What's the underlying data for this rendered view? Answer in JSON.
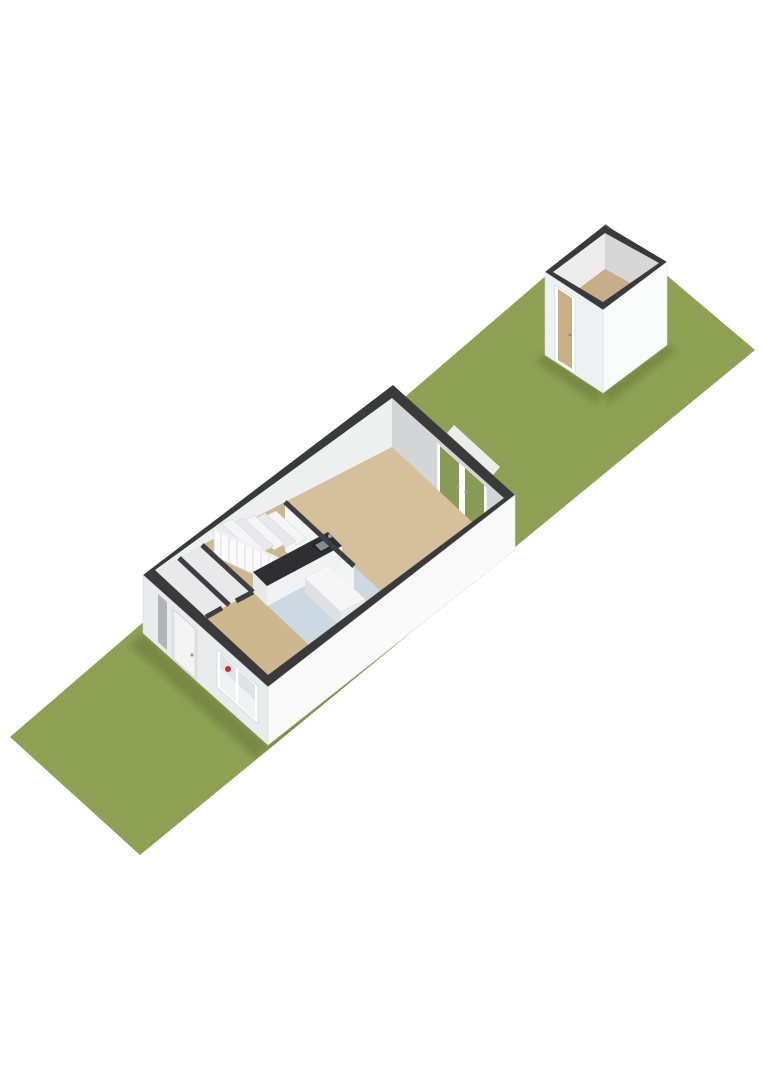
{
  "scene": {
    "type": "isometric-3d-floorplan",
    "background": "#ffffff",
    "views": {
      "plot": "long-garden-strip",
      "building": "ground-floor-open-top",
      "outbuilding": "garden-shed"
    }
  },
  "colors": {
    "grass": "#90a355",
    "grassSpeckle": "#55661f",
    "shadow": "#2f3a18",
    "rim": "#3a3a3b",
    "wallIntNW": "#eef0f0",
    "wallIntNE": "#d3d5d6",
    "wallExtSW": "#e9ebec",
    "wallExtSE": "#fafafa",
    "partitionFace": "#f4f5f5",
    "floorLiving": "#d6c09c",
    "floorHall": "#cdb78f",
    "floorKitchen": "#ccd8e2",
    "floorWc": "#e9e9e9",
    "floorEntry": "#cdb78f",
    "floorShed": "#c7ad89",
    "stairTreadA": "#f5f5f5",
    "stairTreadB": "#e9e9eb",
    "railing": "#fafafa",
    "counterTop": "#2f2f31",
    "counterFront": "#f2f2f3",
    "counterEnd": "#e8e8ea",
    "islandTop": "#f6f6f7",
    "islandSE": "#e9eaeb",
    "islandSW": "#dfe0e2",
    "sinkOuter": "#222426",
    "sinkInner": "#868b8e",
    "faucet": "#9aa0a4",
    "redAccent": "#c4342c",
    "doorFrame": "#ffffff",
    "doorPanel": "#f4f4f4",
    "sideliteGlass": "#b0b4b6",
    "windowGlass": "#dde4e9",
    "windowGlassLower": "#f0f2f3",
    "glassGreen": "#879b54",
    "sill": "#ededed",
    "shedDoorPanel": "#c9ae86",
    "shedWallIntNW": "#ececec",
    "shedWallIntNE": "#d7d7d8",
    "shedWallExtSW": "#eef0f1",
    "shedWallExtSE": "#fafbfb"
  }
}
